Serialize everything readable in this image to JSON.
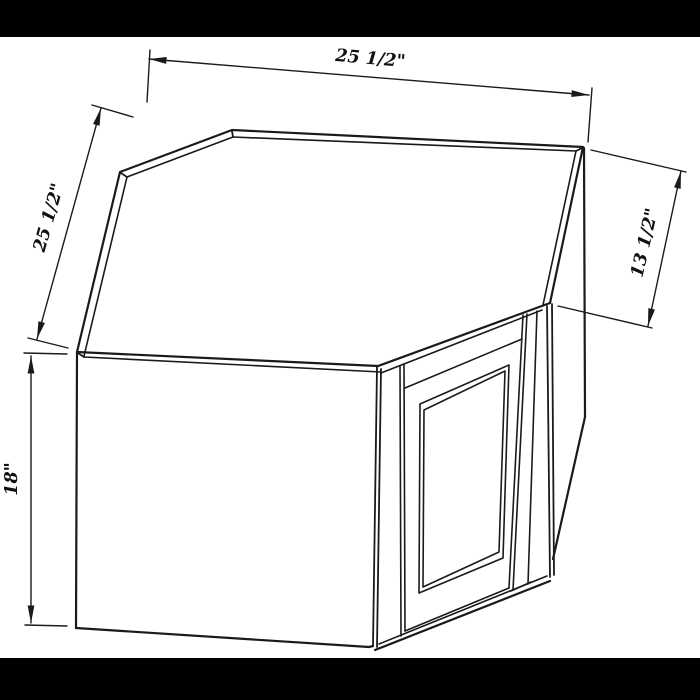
{
  "figure": {
    "type": "technical-line-drawing",
    "subject": "diagonal-corner-wall-cabinet",
    "style": "black line art on white, letterboxed with black bars"
  },
  "colors": {
    "line": "#1a1a1a",
    "background": "#ffffff",
    "letterbox": "#000000"
  },
  "dimensions": {
    "top_width": {
      "label": "25 1/2\"",
      "inches": 25.5,
      "measures": "back-right wall edge width"
    },
    "left_width": {
      "label": "25 1/2\"",
      "inches": 25.5,
      "measures": "back-left wall edge width"
    },
    "right_depth": {
      "label": "13 1/2\"",
      "inches": 13.5,
      "measures": "right side depth"
    },
    "height": {
      "label": "18\"",
      "inches": 18,
      "measures": "cabinet height"
    }
  }
}
